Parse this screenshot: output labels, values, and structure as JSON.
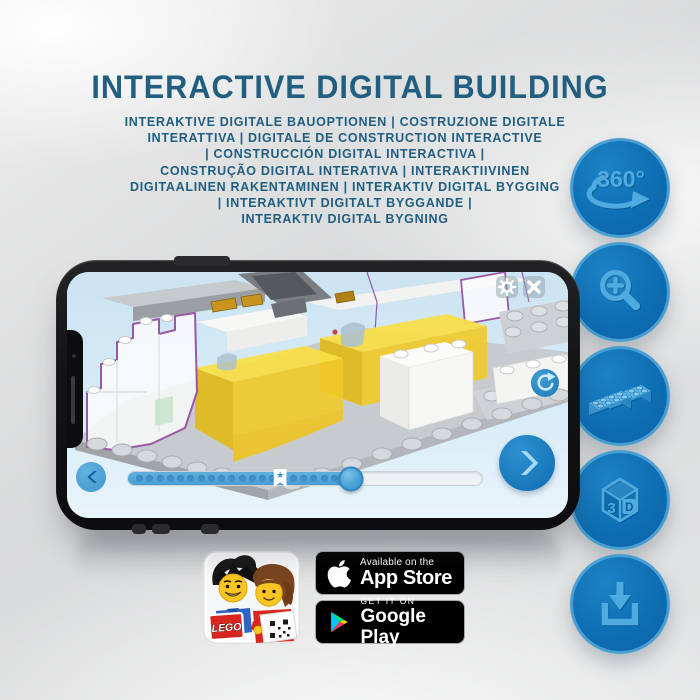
{
  "title": "INTERACTIVE DIGITAL BUILDING",
  "subtitle_lines": [
    "INTERAKTIVE DIGITALE BAUOPTIONEN | COSTRUZIONE DIGITALE",
    "INTERATTIVA | DIGITALE DE CONSTRUCTION INTERACTIVE",
    "| CONSTRUCCIÓN DIGITAL INTERACTIVA |",
    "CONSTRUÇÃO DIGITAL INTERATIVA | INTERAKTIIVINEN",
    "DIGITAALINEN RAKENTAMINEN | INTERAKTIV DIGITAL BYGGING",
    "| INTERAKTIVT DIGITALT BYGGANDE |",
    "INTERAKTIV DIGITAL BYGNING"
  ],
  "feature_badges": {
    "rotation_label": "360°",
    "cube_digit": "3",
    "cube_letter": "D",
    "icon_names": [
      "360-rotation-icon",
      "zoom-in-icon",
      "bricks-icon",
      "3d-cube-icon",
      "download-icon"
    ]
  },
  "phone_app": {
    "slider": {
      "progress_percent": 63,
      "bookmark_percent": 43,
      "dot_count": 20
    },
    "icon_names": [
      "gear-icon",
      "close-icon",
      "rotate-icon",
      "chevron-left-icon",
      "chevron-right-icon",
      "bookmark-star-icon"
    ]
  },
  "icons": {
    "bookmark_star": "★"
  },
  "store_badges": {
    "app_store": {
      "tagline": "Available on the",
      "name": "App Store"
    },
    "google_play": {
      "tagline": "GET IT ON",
      "name": "Google Play"
    }
  },
  "app_icon": {
    "logo_text": "LEGO"
  },
  "colors": {
    "headline_blue": "#215e80",
    "badge_circle_blue": "#0e6fb4",
    "badge_glyph_blue": "#4fabdf",
    "screen_sky_blue": "#cde4f2",
    "slider_blue": "#4a9cd2",
    "brick_yellow": "#f6d73e",
    "outline_purple": "#9a57a7",
    "store_badge_black": "#000000",
    "lego_red": "#d7261f"
  }
}
